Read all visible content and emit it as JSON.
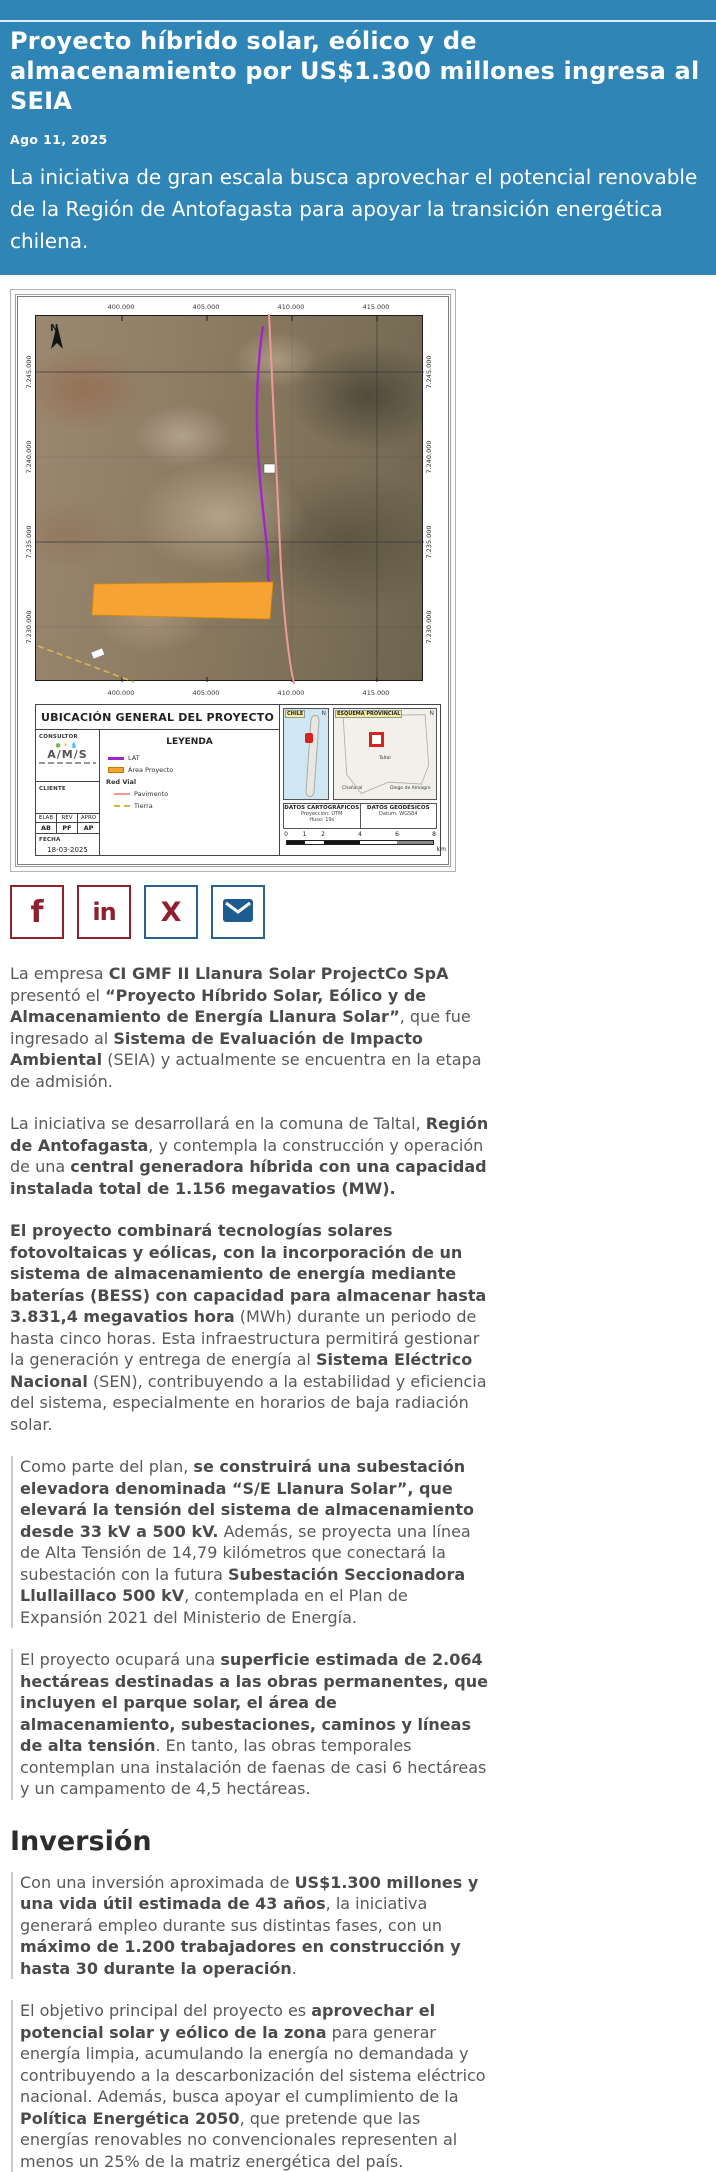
{
  "theme": {
    "header_bg": "#2f86b6",
    "maroon": "#8e2130",
    "steel_blue": "#2a6191",
    "mail_blue": "#1d5c8f",
    "text": "#58595b",
    "bold_text": "#4a4b4d",
    "heading": "#2d2d2d",
    "border_gray": "#cccccc",
    "map_orange": "#f5a333",
    "lat_purple": "#a224cf",
    "road_pink": "#ef9a9a"
  },
  "header": {
    "title": "Proyecto híbrido solar, eólico y de almacenamiento por US$1.300 millones ingresa al SEIA",
    "date": "Ago 11, 2025",
    "lede": "La iniciativa de gran escala busca aprovechar el potencial renovable de la Región de Antofagasta para apoyar la transición energética chilena."
  },
  "map": {
    "title": "UBICACIÓN GENERAL DEL PROYECTO",
    "north": "N",
    "coords_x": [
      "400.000",
      "405.000",
      "410.000",
      "415.000"
    ],
    "coords_y": [
      "7.245.000",
      "7.240.000",
      "7.235.000",
      "7.230.000"
    ],
    "consultor_label": "CONSULTOR",
    "consultor_name": "A/M/S",
    "cliente_label": "CLIENTE",
    "legend": {
      "title": "LEYENDA",
      "items": [
        {
          "label": "LAT"
        },
        {
          "label": "Área Proyecto"
        },
        {
          "label": "Red Vial"
        },
        {
          "label": "Pavimento"
        },
        {
          "label": "Tierra"
        }
      ]
    },
    "approvals": {
      "headers": [
        "ELAB",
        "REV",
        "APRO"
      ],
      "values": [
        "AB",
        "PF",
        "AP"
      ],
      "fecha_label": "FECHA",
      "fecha": "18-03-2025"
    },
    "insets": {
      "chile_label": "CHILE",
      "esquema_label": "ESQUEMA PROVINCIAL",
      "taltal": "Taltal",
      "chanaral": "Chañaral",
      "diego": "Diego de Almagro",
      "north": "N"
    },
    "datos_cartograficos": {
      "title": "DATOS CARTOGRÁFICOS",
      "line1": "Proyección: UTM",
      "line2": "Huso: 19s"
    },
    "datos_geodesicos": {
      "title": "DATOS GEODÉSICOS",
      "line1": "Datum: WGS84"
    },
    "scale": {
      "ticks": [
        "0",
        "1",
        "2",
        "4",
        "6",
        "8"
      ],
      "unit": "km"
    }
  },
  "share": {
    "facebook": "f",
    "linkedin": "in",
    "x": "X",
    "email": "envelope"
  },
  "article": {
    "section_heading": "Inversión",
    "paragraphs_before": [
      {
        "bar": false,
        "segments": [
          {
            "t": "La empresa ",
            "b": false
          },
          {
            "t": "CI GMF II Llanura Solar ProjectCo SpA",
            "b": true
          },
          {
            "t": " presentó el ",
            "b": false
          },
          {
            "t": "“Proyecto Híbrido Solar, Eólico y de Almacenamiento de Energía Llanura Solar”",
            "b": true
          },
          {
            "t": ", que fue ingresado al ",
            "b": false
          },
          {
            "t": "Sistema de Evaluación de Impacto Ambiental",
            "b": true
          },
          {
            "t": " (SEIA) y actualmente se encuentra en la etapa de admisión.",
            "b": false
          }
        ]
      },
      {
        "bar": false,
        "segments": [
          {
            "t": "La iniciativa se desarrollará en la comuna de Taltal, ",
            "b": false
          },
          {
            "t": "Región de Antofagasta",
            "b": true
          },
          {
            "t": ", y contempla la construcción y operación de una ",
            "b": false
          },
          {
            "t": "central generadora híbrida con una capacidad instalada total de 1.156 megavatios (MW).",
            "b": true
          }
        ]
      },
      {
        "bar": false,
        "segments": [
          {
            "t": "El proyecto combinará tecnologías solares fotovoltaicas y eólicas, con la incorporación de un sistema de almacenamiento de energía mediante baterías (BESS) con capacidad para almacenar hasta 3.831,4 megavatios hora",
            "b": true
          },
          {
            "t": " (MWh) durante un periodo de hasta cinco horas. Esta infraestructura permitirá gestionar la generación y entrega de energía al ",
            "b": false
          },
          {
            "t": "Sistema Eléctrico Nacional",
            "b": true
          },
          {
            "t": " (SEN), contribuyendo a la estabilidad y eficiencia del sistema, especialmente en horarios de baja radiación solar.",
            "b": false
          }
        ]
      },
      {
        "bar": true,
        "segments": [
          {
            "t": "Como parte del plan, ",
            "b": false
          },
          {
            "t": "se construirá una subestación elevadora denominada “S/E Llanura Solar”, que elevará la tensión del sistema de almacenamiento desde 33 kV a 500 kV.",
            "b": true
          },
          {
            "t": " Además, se proyecta una línea de Alta Tensión de 14,79 kilómetros que conectará la subestación con la futura ",
            "b": false
          },
          {
            "t": "Subestación Seccionadora Llullaillaco 500 kV",
            "b": true
          },
          {
            "t": ", contemplada en el Plan de Expansión 2021 del Ministerio de Energía.",
            "b": false
          }
        ]
      },
      {
        "bar": true,
        "segments": [
          {
            "t": "El proyecto ocupará una ",
            "b": false
          },
          {
            "t": "superficie estimada de 2.064 hectáreas destinadas a las obras permanentes, que incluyen el parque solar, el área de almacenamiento, subestaciones, caminos y líneas de alta tensión",
            "b": true
          },
          {
            "t": ". En tanto, las obras temporales contemplan una instalación de faenas de casi 6 hectáreas y un campamento de 4,5 hectáreas.",
            "b": false
          }
        ]
      }
    ],
    "paragraphs_after": [
      {
        "bar": true,
        "segments": [
          {
            "t": "Con una inversión aproximada de ",
            "b": false
          },
          {
            "t": "US$1.300 millones y una vida útil estimada de 43 años",
            "b": true
          },
          {
            "t": ", la iniciativa generará empleo durante sus distintas fases, con un ",
            "b": false
          },
          {
            "t": "máximo de 1.200 trabajadores en construcción y hasta 30 durante la operación",
            "b": true
          },
          {
            "t": ".",
            "b": false
          }
        ]
      },
      {
        "bar": true,
        "segments": [
          {
            "t": "El objetivo principal del proyecto es ",
            "b": false
          },
          {
            "t": "aprovechar el potencial solar y eólico de la zona",
            "b": true
          },
          {
            "t": " para generar energía limpia, acumulando la energía no demandada y contribuyendo a la descarbonización del sistema eléctrico nacional. Además, busca apoyar el cumplimiento de la ",
            "b": false
          },
          {
            "t": "Política Energética 2050",
            "b": true
          },
          {
            "t": ", que pretende que las energías renovables no convencionales representen al menos un 25% de la matriz energética del país.",
            "b": false
          }
        ]
      }
    ]
  }
}
